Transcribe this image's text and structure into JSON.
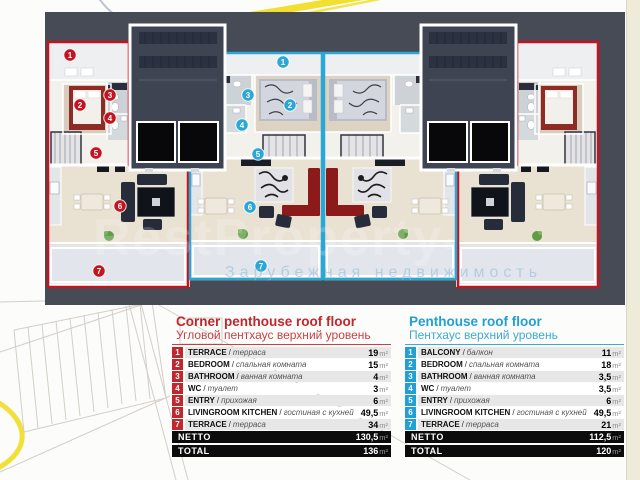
{
  "watermark": {
    "brand": "RestProperty",
    "reg": "®",
    "tagline": "Зарубежная недвижимость"
  },
  "plan": {
    "colors": {
      "corner": "#c41420",
      "penthouse": "#2aa7d4"
    },
    "markers": [
      {
        "group": "corner",
        "num": "1",
        "x": 25,
        "y": 43
      },
      {
        "group": "corner",
        "num": "2",
        "x": 35,
        "y": 93
      },
      {
        "group": "corner",
        "num": "3",
        "x": 65,
        "y": 83
      },
      {
        "group": "corner",
        "num": "4",
        "x": 65,
        "y": 106
      },
      {
        "group": "corner",
        "num": "5",
        "x": 51,
        "y": 141
      },
      {
        "group": "corner",
        "num": "6",
        "x": 75,
        "y": 194
      },
      {
        "group": "corner",
        "num": "7",
        "x": 54,
        "y": 259
      },
      {
        "group": "penthouse",
        "num": "1",
        "x": 238,
        "y": 50
      },
      {
        "group": "penthouse",
        "num": "2",
        "x": 245,
        "y": 93
      },
      {
        "group": "penthouse",
        "num": "3",
        "x": 203,
        "y": 83
      },
      {
        "group": "penthouse",
        "num": "4",
        "x": 197,
        "y": 113
      },
      {
        "group": "penthouse",
        "num": "5",
        "x": 213,
        "y": 142
      },
      {
        "group": "penthouse",
        "num": "6",
        "x": 205,
        "y": 195
      },
      {
        "group": "penthouse",
        "num": "7",
        "x": 216,
        "y": 254
      }
    ]
  },
  "legend": {
    "unit": "m²",
    "tables": [
      {
        "id": "corner",
        "accent": "#c1272d",
        "title": "Corner penthouse roof floor",
        "subtitle": "Угловой пентхаус верхний уровень",
        "rows": [
          {
            "num": "1",
            "name": "TERRACE",
            "name_ru": "терраса",
            "area": "19"
          },
          {
            "num": "2",
            "name": "BEDROOM",
            "name_ru": "спальная комната",
            "area": "15"
          },
          {
            "num": "3",
            "name": "BATHROOM",
            "name_ru": "ванная комната",
            "area": "4"
          },
          {
            "num": "4",
            "name": "WC",
            "name_ru": "туалет",
            "area": "3"
          },
          {
            "num": "5",
            "name": "ENTRY",
            "name_ru": "прихожая",
            "area": "6"
          },
          {
            "num": "6",
            "name": "LIVINGROOM KITCHEN",
            "name_ru": "гостиная с кухней",
            "area": "49,5"
          },
          {
            "num": "7",
            "name": "TERRACE",
            "name_ru": "терраса",
            "area": "34"
          }
        ],
        "totals": [
          {
            "label": "NETTO",
            "area": "130,5"
          },
          {
            "label": "TOTAL",
            "area": "136"
          }
        ]
      },
      {
        "id": "penthouse",
        "accent": "#219fd6",
        "title": "Penthouse roof floor",
        "subtitle": "Пентхаус верхний уровень",
        "rows": [
          {
            "num": "1",
            "name": "BALCONY",
            "name_ru": "балкон",
            "area": "11"
          },
          {
            "num": "2",
            "name": "BEDROOM",
            "name_ru": "спальная комната",
            "area": "18"
          },
          {
            "num": "3",
            "name": "BATHROOM",
            "name_ru": "ванная комната",
            "area": "3,5"
          },
          {
            "num": "4",
            "name": "WC",
            "name_ru": "туалет",
            "area": "3,5"
          },
          {
            "num": "5",
            "name": "ENTRY",
            "name_ru": "прихожая",
            "area": "6"
          },
          {
            "num": "6",
            "name": "LIVINGROOM KITCHEN",
            "name_ru": "гостиная с кухней",
            "area": "49,5"
          },
          {
            "num": "7",
            "name": "TERRACE",
            "name_ru": "терраса",
            "area": "21"
          }
        ],
        "totals": [
          {
            "label": "NETTO",
            "area": "112,5"
          },
          {
            "label": "TOTAL",
            "area": "120"
          }
        ]
      }
    ]
  }
}
